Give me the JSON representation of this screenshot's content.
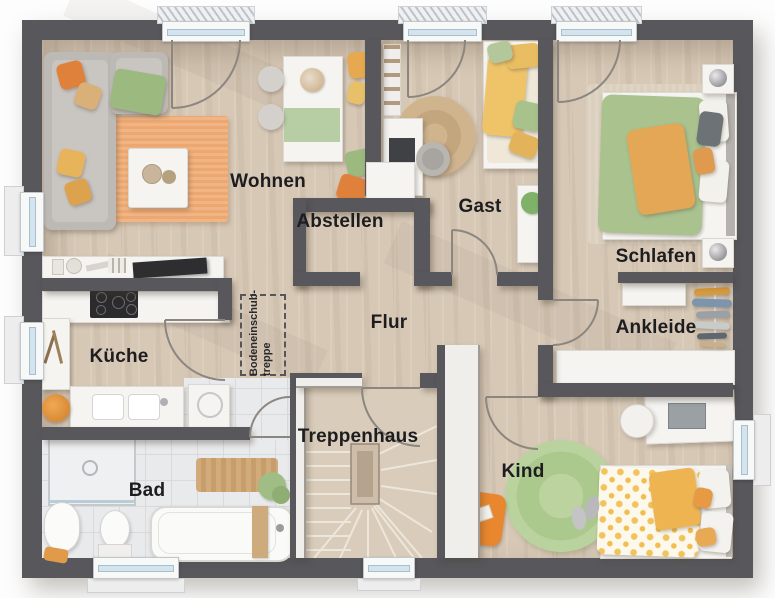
{
  "rooms": [
    {
      "id": "wohnen",
      "label": "Wohnen"
    },
    {
      "id": "abstellen",
      "label": "Abstellen"
    },
    {
      "id": "gast",
      "label": "Gast"
    },
    {
      "id": "schlafen",
      "label": "Schlafen"
    },
    {
      "id": "kueche",
      "label": "Küche"
    },
    {
      "id": "flur",
      "label": "Flur"
    },
    {
      "id": "ankleide",
      "label": "Ankleide"
    },
    {
      "id": "treppenhaus",
      "label": "Treppenhaus"
    },
    {
      "id": "bad",
      "label": "Bad"
    },
    {
      "id": "kind",
      "label": "Kind"
    }
  ],
  "attic_stairs": {
    "line1": "Bodeneinschub-",
    "line2": "treppe"
  },
  "colors": {
    "wall": "#57575c",
    "floor_wood": "#d7c8b6",
    "tile": "#e9eaec",
    "accent_orange": "#e0813b",
    "accent_yellow": "#eec36a",
    "accent_green": "#a9c28e",
    "rug_orange": "#eda871",
    "rug_green": "#b9d29e",
    "label_text": "#1d1d1f"
  }
}
